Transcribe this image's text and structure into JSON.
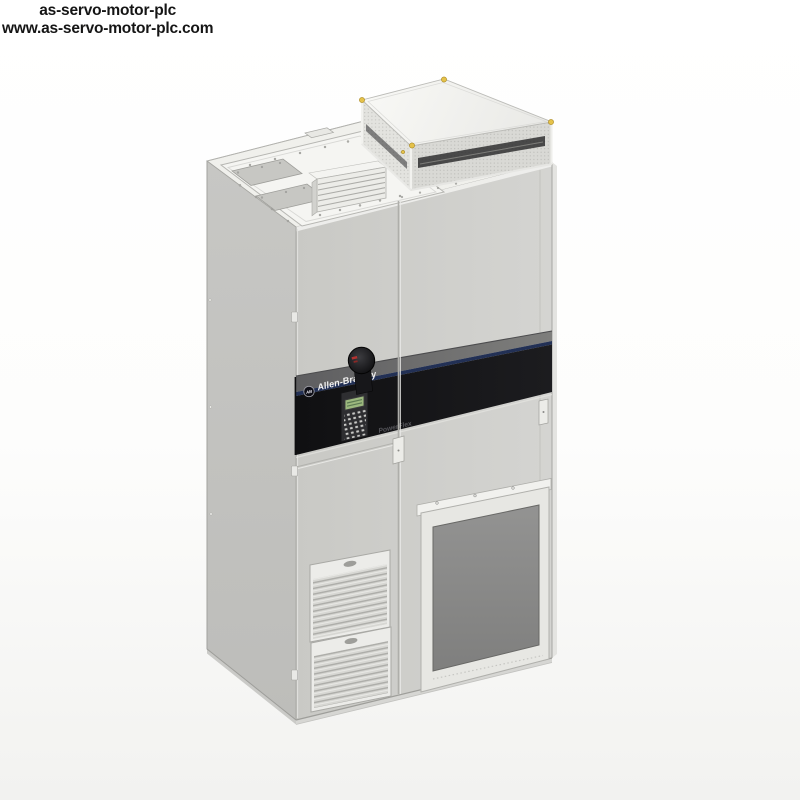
{
  "watermark": {
    "line1": "as-servo-motor-plc",
    "line2": "www.as-servo-motor-plc.com"
  },
  "product_image": {
    "labels": {
      "brand": "Allen-Bradley",
      "model": "PowerFlex",
      "logo_monogram": "AB"
    },
    "colors": {
      "text_color": "#151515",
      "cabinet_front": "#cdcdc9",
      "cabinet_side": "#c2c2bf",
      "cabinet_top": "#f0f0ec",
      "top_plate": "#f5f5f2",
      "band_black": "#131315",
      "band_bevel": "#6a6a6c",
      "band_blue": "#223055",
      "brand_text": "#f2f2f2",
      "model_text": "#55555a",
      "keypad_dark": "#2e2e31",
      "lcd_green": "#9cb87e",
      "knob_black": "#151517",
      "knob_red": "#b23230",
      "screw_yellow": "#e5c24a",
      "filter_dark": "#8a8a88",
      "frame_light": "#ecece9",
      "grille_base": "#d7d7d3",
      "outline": "#a0a09c"
    }
  }
}
